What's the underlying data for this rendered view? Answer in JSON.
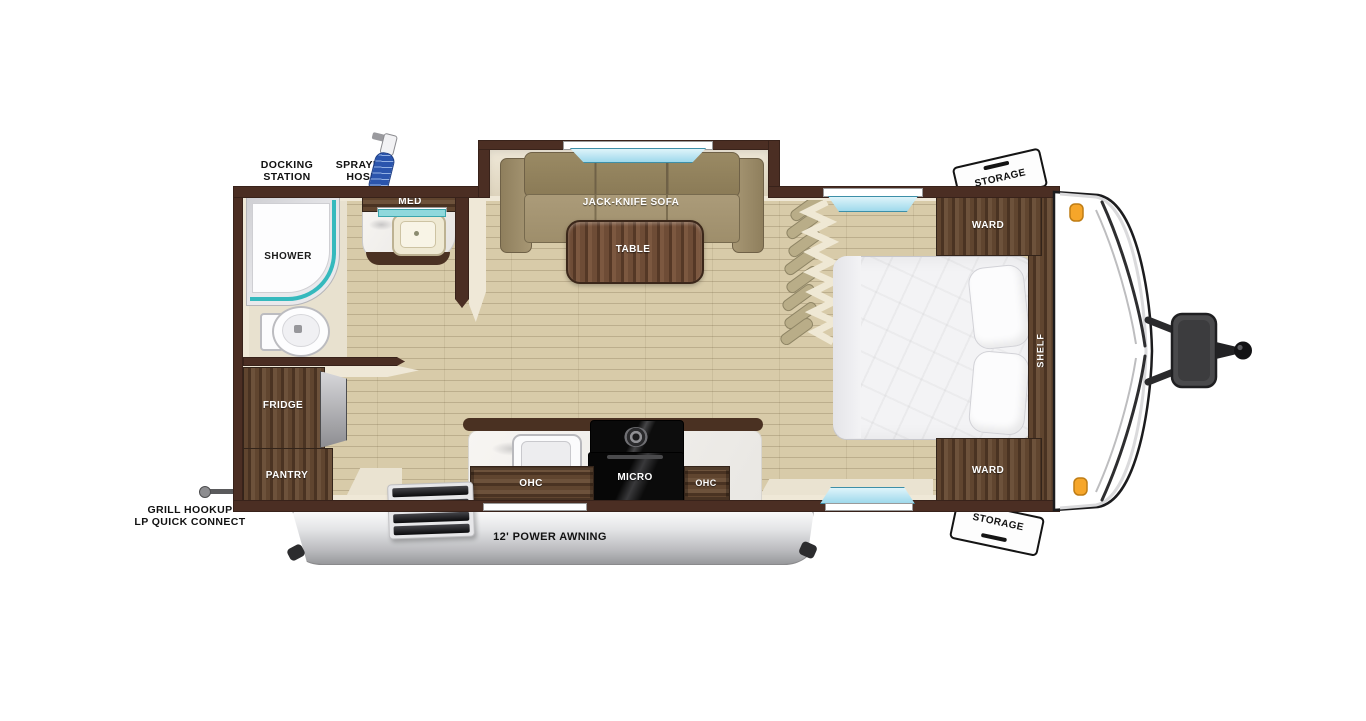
{
  "labels": {
    "docking_station_l1": "DOCKING",
    "docking_station_l2": "STATION",
    "sprayer_hose_l1": "SPRAYER",
    "sprayer_hose_l2": "HOSE",
    "med": "MED",
    "shower": "SHOWER",
    "sofa": "JACK-KNIFE SOFA",
    "table": "TABLE",
    "ward_top": "WARD",
    "ward_bottom": "WARD",
    "shelf": "SHELF",
    "storage_top": "STORAGE",
    "storage_bottom": "STORAGE",
    "fridge": "FRIDGE",
    "pantry": "PANTRY",
    "ohc_left": "OHC",
    "ohc_right": "OHC",
    "micro": "MICRO",
    "awning": "12' POWER AWNING",
    "grill_l1": "GRILL HOOKUP",
    "grill_l2": "LP QUICK CONNECT"
  },
  "colors": {
    "wall_brown": "#4b2e23",
    "floor_tan": "#d8cba9",
    "cabinet_wood": "#5a4130",
    "sofa_tan": "#a3926f",
    "window_glass": "#aadcee",
    "shower_glass": "#35b9bd",
    "marker_light_orange": "#f6a62a",
    "awning_silver": "#c8c9cb",
    "hitch_gray": "#3a3a3c"
  }
}
